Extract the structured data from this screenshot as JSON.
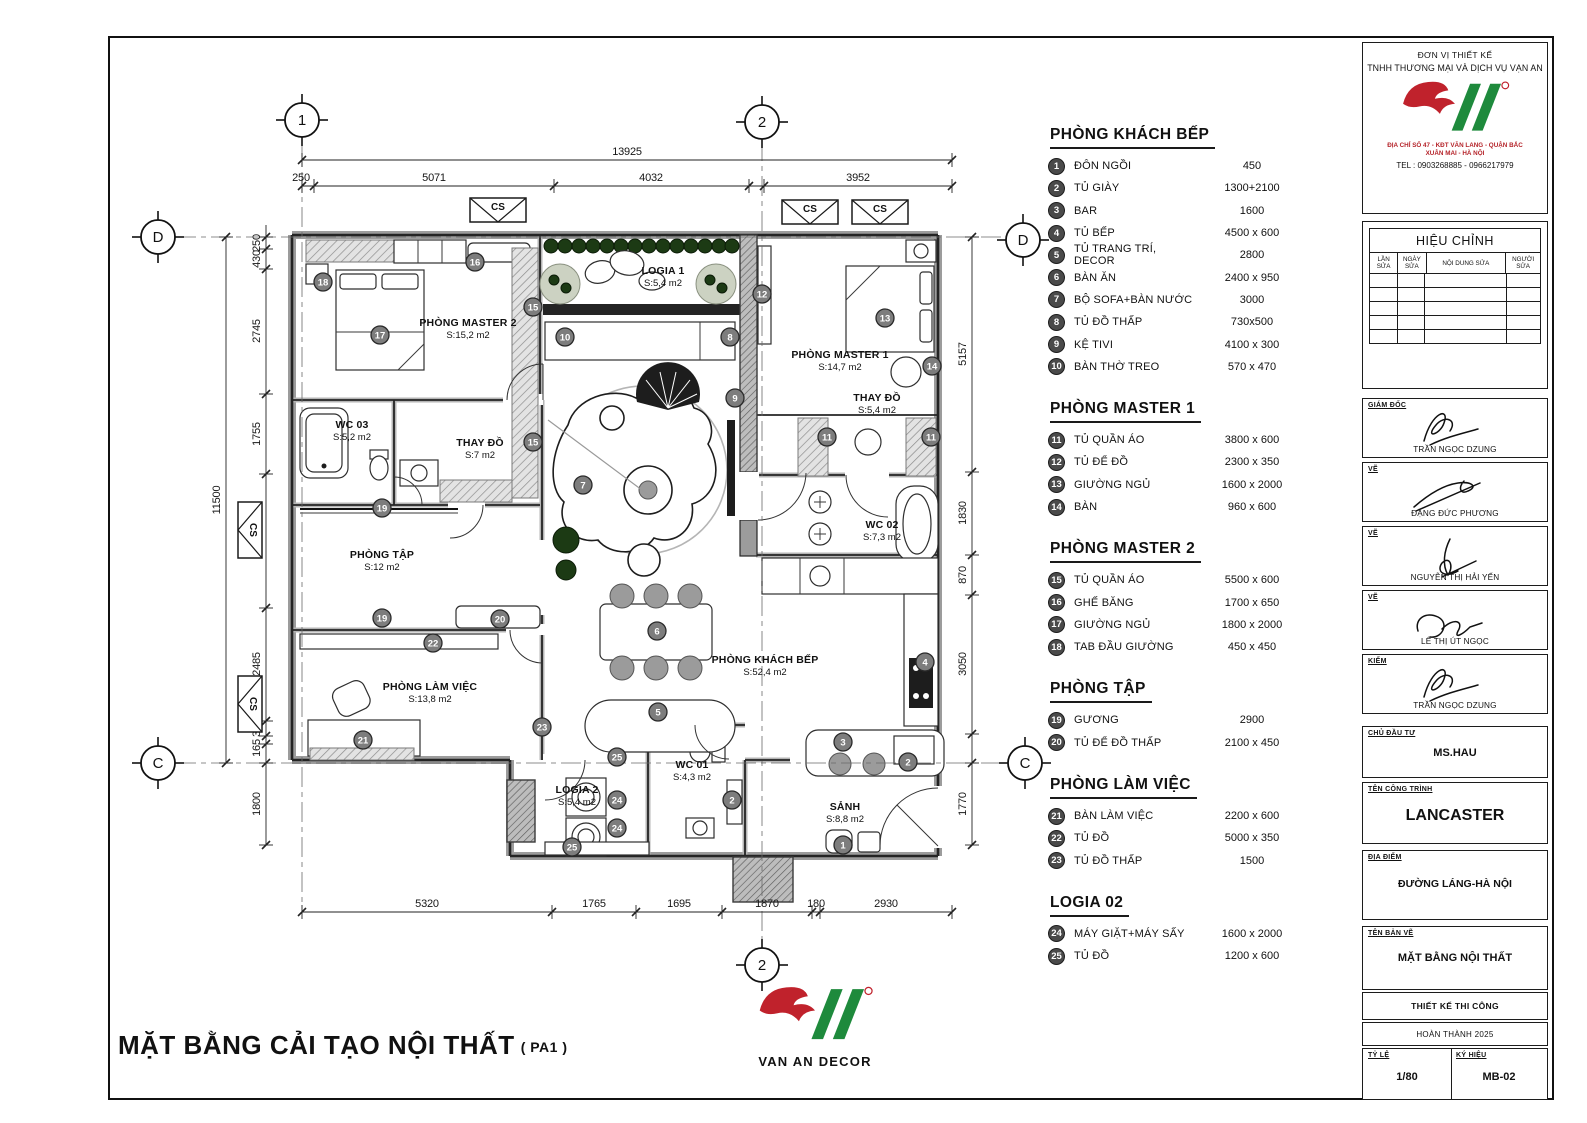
{
  "sheet": {
    "drawing_title": "MẶT BẰNG CẢI TẠO NỘI THẤT",
    "drawing_title_suffix": "( PA1 )"
  },
  "logo": {
    "brand": "VAN AN DECOR"
  },
  "legend": {
    "sections": [
      {
        "title": "PHÒNG KHÁCH BẾP",
        "items": [
          {
            "n": "1",
            "label": "ĐÔN NGỒI",
            "size": "450"
          },
          {
            "n": "2",
            "label": "TỦ GIÀY",
            "size": "1300+2100"
          },
          {
            "n": "3",
            "label": "BAR",
            "size": "1600"
          },
          {
            "n": "4",
            "label": "TỦ BẾP",
            "size": "4500 x 600"
          },
          {
            "n": "5",
            "label": "TỦ TRANG TRÍ, DECOR",
            "size": "2800"
          },
          {
            "n": "6",
            "label": "BÀN ĂN",
            "size": "2400 x 950"
          },
          {
            "n": "7",
            "label": "BỘ SOFA+BÀN NƯỚC",
            "size": "3000"
          },
          {
            "n": "8",
            "label": "TỦ ĐỒ THẤP",
            "size": "730x500"
          },
          {
            "n": "9",
            "label": "KỆ TIVI",
            "size": "4100 x 300"
          },
          {
            "n": "10",
            "label": "BÀN THỜ TREO",
            "size": "570 x 470"
          }
        ]
      },
      {
        "title": "PHÒNG MASTER 1",
        "items": [
          {
            "n": "11",
            "label": "TỦ QUẦN ÁO",
            "size": "3800 x 600"
          },
          {
            "n": "12",
            "label": "TỦ ĐỂ ĐỒ",
            "size": "2300 x 350"
          },
          {
            "n": "13",
            "label": "GIƯỜNG NGỦ",
            "size": "1600 x 2000"
          },
          {
            "n": "14",
            "label": "BÀN",
            "size": "960 x 600"
          }
        ]
      },
      {
        "title": "PHÒNG MASTER 2",
        "items": [
          {
            "n": "15",
            "label": "TỦ QUẦN ÁO",
            "size": "5500 x 600"
          },
          {
            "n": "16",
            "label": "GHẾ BĂNG",
            "size": "1700 x 650"
          },
          {
            "n": "17",
            "label": "GIƯỜNG NGỦ",
            "size": "1800 x 2000"
          },
          {
            "n": "18",
            "label": "TAB ĐẦU GIƯỜNG",
            "size": "450 x 450"
          }
        ]
      },
      {
        "title": "PHÒNG TẬP",
        "items": [
          {
            "n": "19",
            "label": "GƯƠNG",
            "size": "2900"
          },
          {
            "n": "20",
            "label": "TỦ ĐỂ ĐỒ THẤP",
            "size": "2100 x 450"
          }
        ]
      },
      {
        "title": "PHÒNG LÀM VIỆC",
        "items": [
          {
            "n": "21",
            "label": "BÀN LÀM VIỆC",
            "size": "2200 x 600"
          },
          {
            "n": "22",
            "label": "TỦ ĐỒ",
            "size": "5000 x 350"
          },
          {
            "n": "23",
            "label": "TỦ ĐỒ THẤP",
            "size": "1500"
          }
        ]
      },
      {
        "title": "LOGIA 02",
        "items": [
          {
            "n": "24",
            "label": "MÁY GIẶT+MÁY SẤY",
            "size": "1600 x 2000"
          },
          {
            "n": "25",
            "label": "TỦ ĐỒ",
            "size": "1200 x 600"
          }
        ]
      }
    ]
  },
  "plan": {
    "cs_label": "CS",
    "grid_bubbles": [
      "1",
      "2",
      "2",
      "D",
      "D",
      "C",
      "C"
    ],
    "rooms": [
      {
        "name": "PHÒNG MASTER 2",
        "area": "S:15,2 m2"
      },
      {
        "name": "WC 03",
        "area": "S:5,2 m2"
      },
      {
        "name": "THAY ĐỒ",
        "area": "S:7 m2"
      },
      {
        "name": "PHÒNG TẬP",
        "area": "S:12 m2"
      },
      {
        "name": "PHÒNG LÀM VIỆC",
        "area": "S:13,8 m2"
      },
      {
        "name": "LOGIA 1",
        "area": "S:5,4 m2"
      },
      {
        "name": "LOGIA 2",
        "area": "S:5,4 m2"
      },
      {
        "name": "WC 01",
        "area": "S:4,3 m2"
      },
      {
        "name": "SẢNH",
        "area": "S:8,8 m2"
      },
      {
        "name": "PHÒNG MASTER 1",
        "area": "S:14,7 m2"
      },
      {
        "name": "THAY ĐỒ",
        "area": "S:5,4 m2"
      },
      {
        "name": "WC 02",
        "area": "S:7,3 m2"
      },
      {
        "name": "PHÒNG KHÁCH BẾP",
        "area": "S:52,4 m2"
      }
    ],
    "callouts": [
      "18",
      "16",
      "17",
      "15",
      "15",
      "10",
      "8",
      "12",
      "13",
      "14",
      "9",
      "11",
      "11",
      "7",
      "6",
      "19",
      "19",
      "20",
      "22",
      "21",
      "23",
      "5",
      "4",
      "3",
      "2",
      "2",
      "1",
      "24",
      "24",
      "25",
      "25"
    ],
    "dims": {
      "top_total": "13925",
      "top": [
        "250",
        "5071",
        "4032",
        "3952"
      ],
      "left_total": "11500",
      "left": [
        "250",
        "430",
        "2745",
        "1755",
        "2930",
        "2485",
        "335",
        "165",
        "1800"
      ],
      "right": [
        "5157",
        "1830",
        "870",
        "3050",
        "1770"
      ],
      "bottom": [
        "5320",
        "1765",
        "1695",
        "1870",
        "180",
        "2930"
      ]
    }
  },
  "titleblock": {
    "design_unit_label": "ĐƠN VỊ THIẾT KẾ",
    "company": "TNHH THƯƠNG MẠI VÀ DỊCH VỤ VẠN AN",
    "address_line1": "ĐỊA CHỈ SỐ 47 - KĐT VĂN LANG - QUẬN BẮC",
    "address_line2": "XUÂN MAI - HÀ NỘI",
    "tel": "TEL :  0903268885 - 0966217979",
    "revision": {
      "title": "HIỆU CHỈNH",
      "cols": [
        "LẦN SỬA",
        "NGÀY SỬA",
        "NỘI DUNG SỬA",
        "NGƯỜI SỬA"
      ]
    },
    "signatures": [
      {
        "role": "GIÁM ĐỐC",
        "name": "TRẦN NGỌC DZUNG"
      },
      {
        "role": "VẼ",
        "name": "ĐẶNG ĐỨC PHƯƠNG"
      },
      {
        "role": "VẼ",
        "name": "NGUYỄN THỊ HẢI YẾN"
      },
      {
        "role": "VẼ",
        "name": "LÊ THỊ ÚT NGỌC"
      },
      {
        "role": "KIỂM",
        "name": "TRẦN NGỌC DZUNG"
      }
    ],
    "fields": [
      {
        "label": "CHỦ ĐẦU TƯ",
        "value": "MS.HAU"
      },
      {
        "label": "TÊN CÔNG TRÌNH",
        "value": "LANCASTER"
      },
      {
        "label": "ĐỊA ĐIỂM",
        "value": "ĐƯỜNG LÁNG-HÀ NỘI"
      },
      {
        "label": "TÊN BẢN VẼ",
        "value": "MẶT BẰNG NỘI THẤT"
      }
    ],
    "design_stage": "THIẾT KẾ THI CÔNG",
    "completion": "HOÀN THÀNH 2025",
    "scale_label": "TỶ LỆ",
    "scale_value": "1/80",
    "code_label": "KÝ HIỆU",
    "code_value": "MB-02"
  }
}
